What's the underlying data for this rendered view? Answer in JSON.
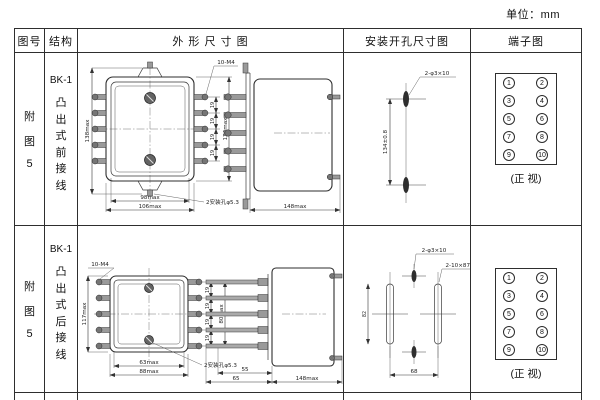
{
  "page": {
    "unit": "单位：mm"
  },
  "headers": {
    "fig_no": "图号",
    "structure": "结构",
    "outline": "外 形 尺 寸 图",
    "install": "安装开孔尺寸图",
    "terminal": "端子图"
  },
  "rows": [
    {
      "fig_chars": [
        "附",
        "图",
        "5"
      ],
      "model": "BK-1",
      "type_chars": [
        "凸",
        "出",
        "式",
        "前",
        "接",
        "线"
      ],
      "outline": {
        "screws_label": "10-M4",
        "height": "138max",
        "pitch": "19",
        "inner_height": "124max",
        "width_inner": "98max",
        "width_outer": "106max",
        "holes_label": "2安装孔φ5.3",
        "depth": "148max"
      },
      "install": {
        "holes_label": "2-φ3×10",
        "v_spacing": "134±0.8"
      },
      "terminal_caption": "(正 视)"
    },
    {
      "fig_chars": [
        "附",
        "图",
        "5"
      ],
      "model": "BK-1",
      "type_chars": [
        "凸",
        "出",
        "式",
        "后",
        "接",
        "线"
      ],
      "outline": {
        "screws_label": "10-M4",
        "height": "117max",
        "pitch": "19",
        "inner_height": "80max",
        "width_inner": "63max",
        "width_outer": "88max",
        "holes_label": "2安装孔φ5.3",
        "stud_inner": "55",
        "stud_outer": "65",
        "depth": "148max"
      },
      "install": {
        "holes_label": "2-φ3×10",
        "slots_label": "2-10×87",
        "v_spacing": "82",
        "h_spacing": "68"
      },
      "terminal_caption": "(正 视)"
    }
  ],
  "terminal_numbers": [
    "1",
    "2",
    "3",
    "4",
    "5",
    "6",
    "7",
    "8",
    "9",
    "10"
  ]
}
